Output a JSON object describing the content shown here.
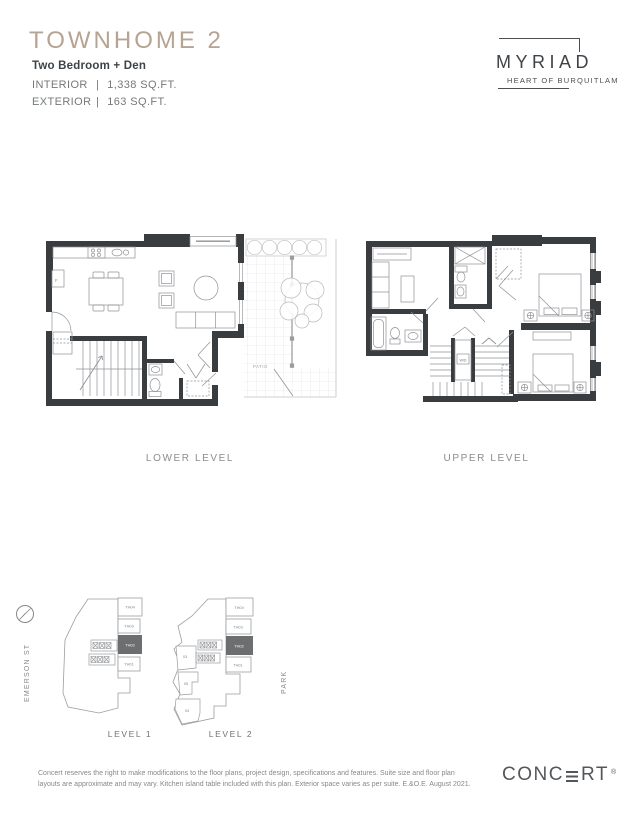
{
  "header": {
    "title": "TOWNHOME 2",
    "subtitle": "Two Bedroom + Den",
    "interior": {
      "label": "INTERIOR",
      "sep": "|",
      "value": "1,338 SQ.FT."
    },
    "exterior": {
      "label": "EXTERIOR",
      "sep": "|",
      "value": "163 SQ.FT."
    }
  },
  "brand": {
    "name": "MYRIAD",
    "tagline": "HEART OF BURQUITLAM"
  },
  "floorplans": {
    "lower_label": "LOWER LEVEL",
    "upper_label": "UPPER LEVEL",
    "annotations": {
      "patio": "PATIO",
      "washer_dryer": "W/D",
      "fridge": "F"
    }
  },
  "keyplans": {
    "street": "EMERSON ST",
    "park": "PARK",
    "level1": {
      "label": "LEVEL 1",
      "units": [
        "TH04",
        "TH03",
        "TH02",
        "TH01"
      ]
    },
    "level2": {
      "label": "LEVEL 2",
      "units": [
        "TH04",
        "TH03",
        "TH02",
        "TH01"
      ],
      "inner_units": [
        "03",
        "05",
        "04"
      ]
    },
    "highlighted_unit": "TH02"
  },
  "footer": {
    "disclaimer": "Concert reserves the right to make modifications to the floor plans, project design, specifications and features. Suite size and floor plan layouts are approximate and may vary. Kitchen island table included with this plan. Exterior space varies as per suite. E.&O.E. August 2021.",
    "logo_prefix": "CONC",
    "logo_suffix": "RT",
    "registered": "®"
  },
  "colors": {
    "accent_title": "#b7a391",
    "highlight_unit": "#6d6e70",
    "wall": "#3a3d40"
  }
}
